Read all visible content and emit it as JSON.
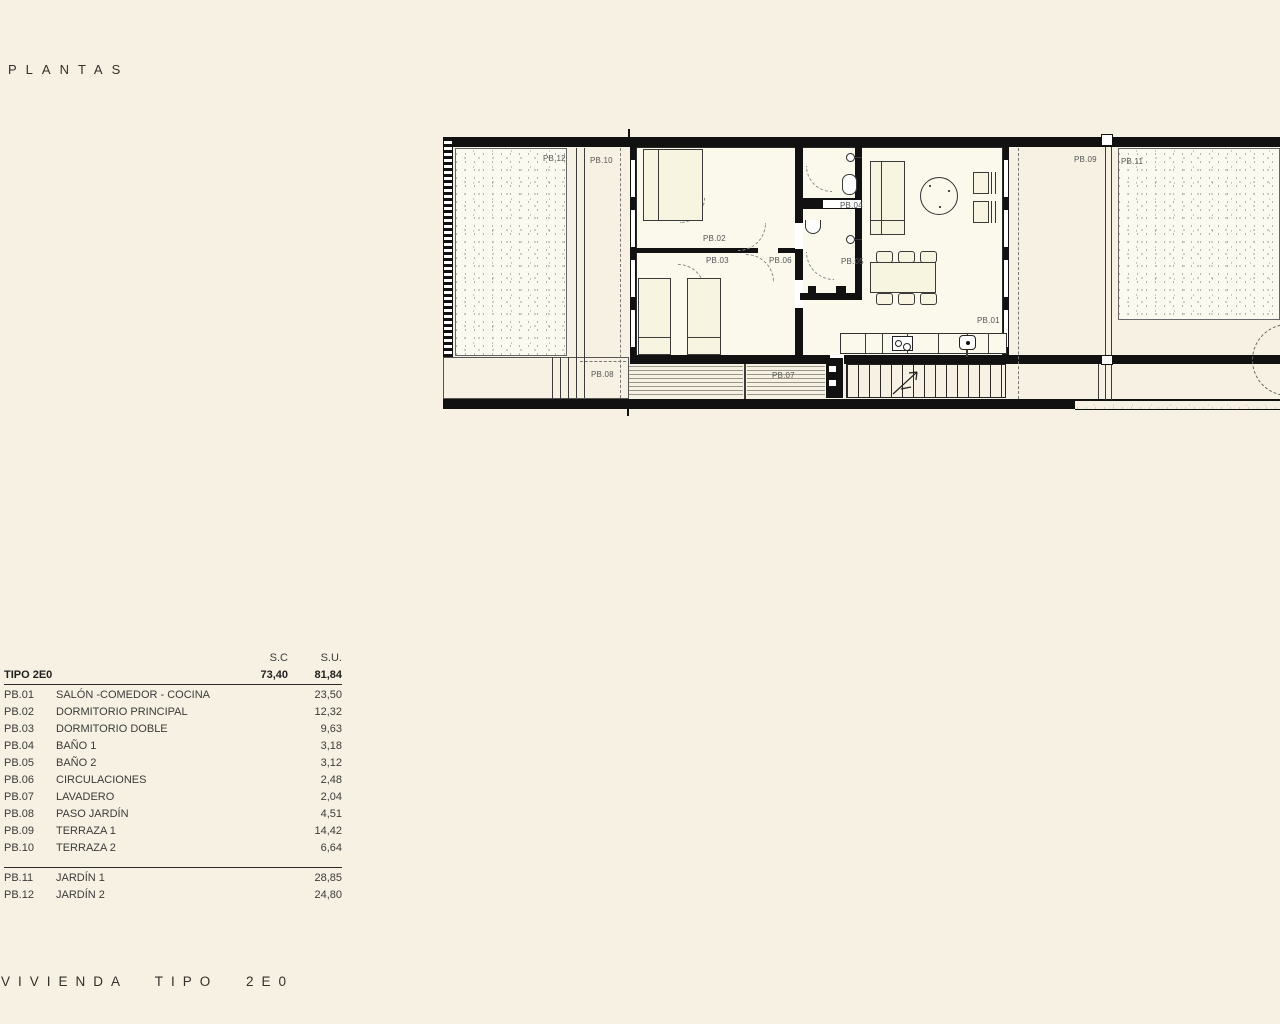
{
  "colors": {
    "background": "#f6f1e2",
    "ink": "#111111",
    "paper": "#fbf8ec",
    "label": "#555555"
  },
  "header": {
    "title": "PLANTAS"
  },
  "footer": {
    "title": "VIVIENDA TIPO 2E0"
  },
  "area_table": {
    "col_sc": "S.C",
    "col_su": "S.U.",
    "summary": {
      "name": "TIPO 2E0",
      "sc": "73,40",
      "su": "81,84"
    },
    "rows": [
      {
        "code": "PB.01",
        "name": "SALÓN -COMEDOR - COCINA",
        "su": "23,50"
      },
      {
        "code": "PB.02",
        "name": "DORMITORIO PRINCIPAL",
        "su": "12,32"
      },
      {
        "code": "PB.03",
        "name": "DORMITORIO DOBLE",
        "su": "9,63"
      },
      {
        "code": "PB.04",
        "name": "BAÑO 1",
        "su": "3,18"
      },
      {
        "code": "PB.05",
        "name": "BAÑO 2",
        "su": "3,12"
      },
      {
        "code": "PB.06",
        "name": "CIRCULACIONES",
        "su": "2,48"
      },
      {
        "code": "PB.07",
        "name": "LAVADERO",
        "su": "2,04"
      },
      {
        "code": "PB.08",
        "name": "PASO JARDÍN",
        "su": "4,51"
      },
      {
        "code": "PB.09",
        "name": "TERRAZA 1",
        "su": "14,42"
      },
      {
        "code": "PB.10",
        "name": "TERRAZA 2",
        "su": "6,64"
      }
    ],
    "rows_exterior": [
      {
        "code": "PB.11",
        "name": "JARDÍN 1",
        "su": "28,85"
      },
      {
        "code": "PB.12",
        "name": "JARDÍN 2",
        "su": "24,80"
      }
    ]
  },
  "plan": {
    "labels": [
      {
        "text": "PB.12",
        "x": 103,
        "y": 26
      },
      {
        "text": "PB.10",
        "x": 150,
        "y": 28
      },
      {
        "text": "PB.02",
        "x": 263,
        "y": 106
      },
      {
        "text": "PB.03",
        "x": 266,
        "y": 128
      },
      {
        "text": "PB.06",
        "x": 329,
        "y": 128
      },
      {
        "text": "PB.04",
        "x": 400,
        "y": 73
      },
      {
        "text": "PB.05",
        "x": 401,
        "y": 129
      },
      {
        "text": "PB.01",
        "x": 537,
        "y": 188
      },
      {
        "text": "PB.09",
        "x": 634,
        "y": 27
      },
      {
        "text": "PB.11",
        "x": 681,
        "y": 29
      },
      {
        "text": "PB.08",
        "x": 151,
        "y": 242
      },
      {
        "text": "PB.07",
        "x": 332,
        "y": 243
      }
    ]
  }
}
